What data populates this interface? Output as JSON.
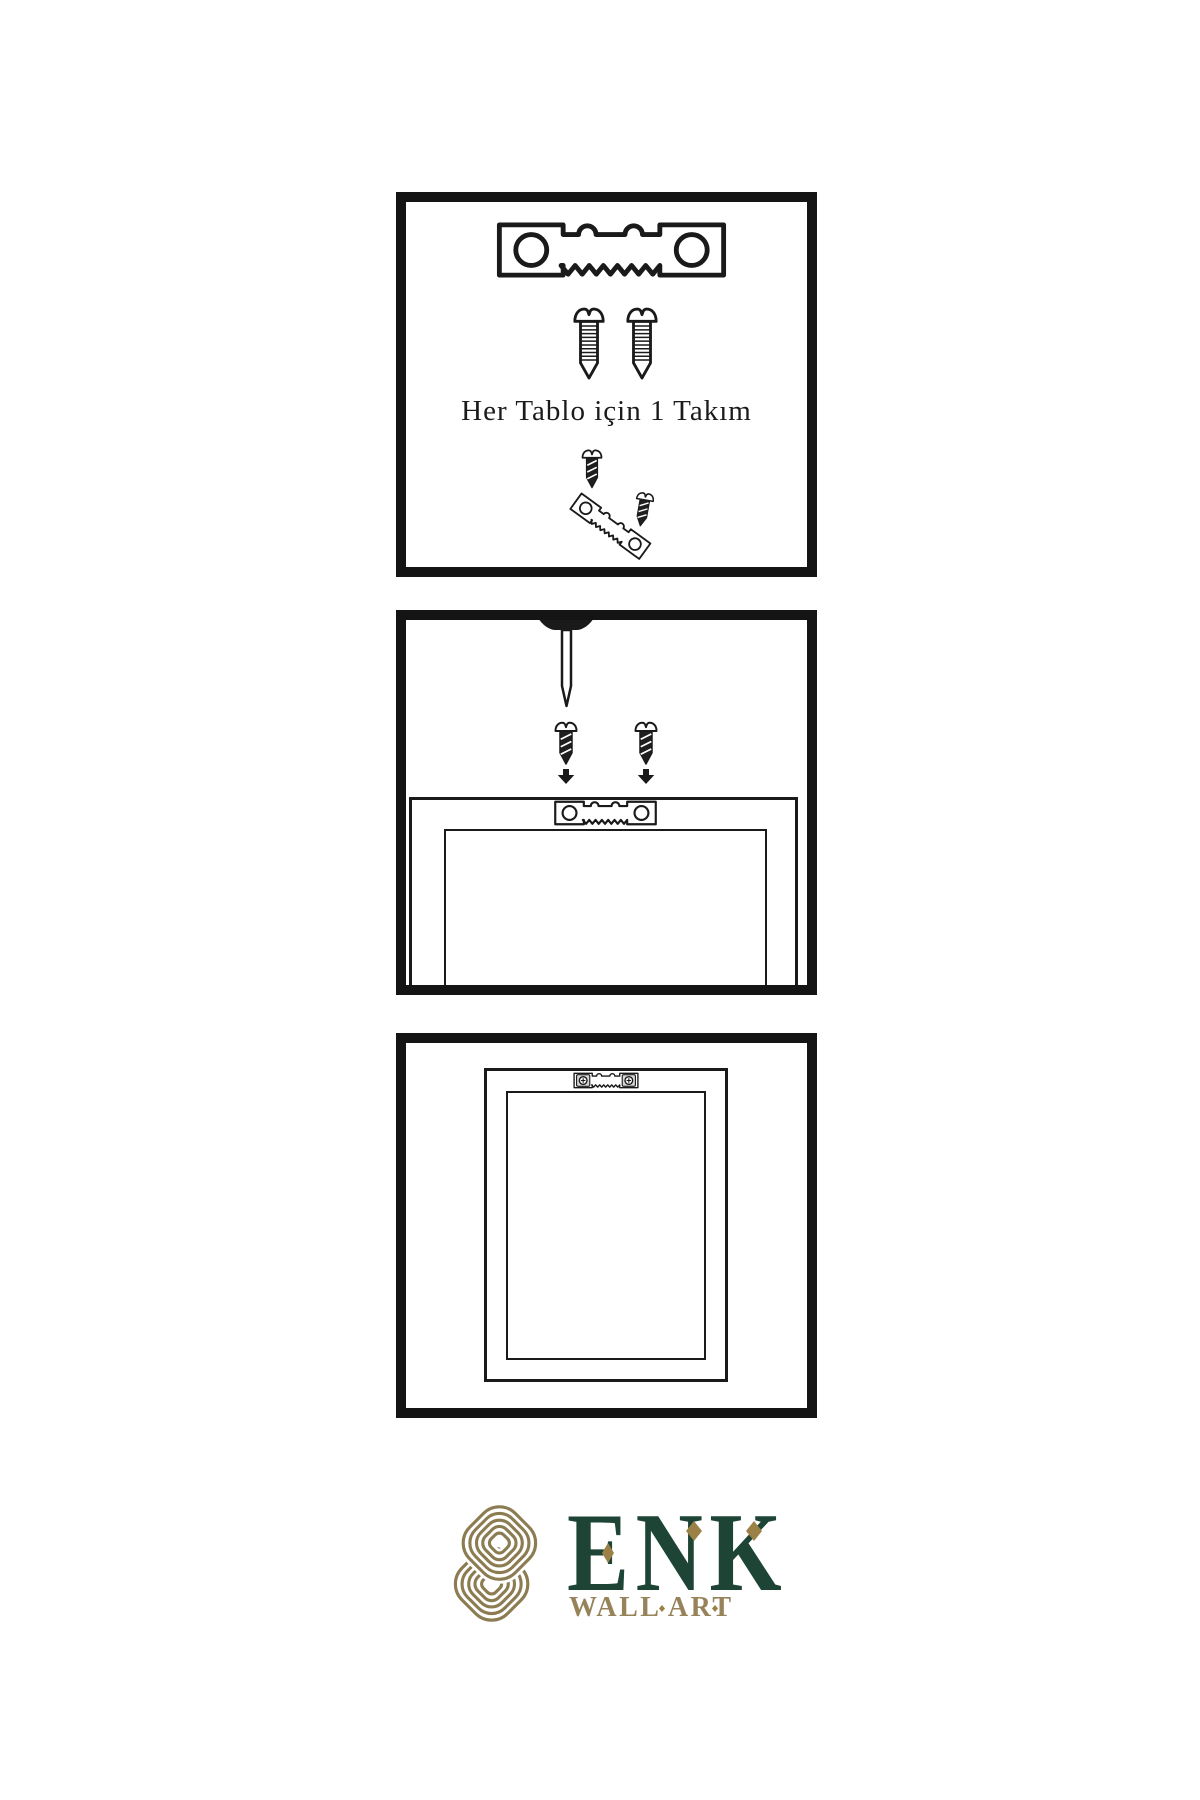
{
  "document": {
    "type": "frame-hanging-instructions",
    "background": "#ffffff",
    "line_color": "#141414"
  },
  "panels": [
    {
      "name": "kit-contents",
      "caption": "Her Tablo için 1 Takım",
      "icons": [
        "sawtooth-hanger-icon",
        "screw-icon",
        "screw-icon",
        "screw-driving-icon",
        "tilted-sawtooth-hanger-icon"
      ]
    },
    {
      "name": "mounting-step",
      "icons": [
        "wall-nail-icon",
        "dark-screw-icon",
        "dark-screw-icon",
        "arrow-down-icon",
        "arrow-down-icon",
        "frame-back-icon",
        "sawtooth-hanger-icon"
      ]
    },
    {
      "name": "hung-frame",
      "icons": [
        "frame-icon",
        "mounted-sawtooth-hanger-icon"
      ]
    }
  ],
  "brand": {
    "name": "ENK",
    "subtitle": "WALL ART",
    "logo": "interlocking-knot-icon",
    "colors": {
      "green": "#1d4434",
      "gold": "#9c8147",
      "knot_gold": "#8c7c51"
    }
  }
}
